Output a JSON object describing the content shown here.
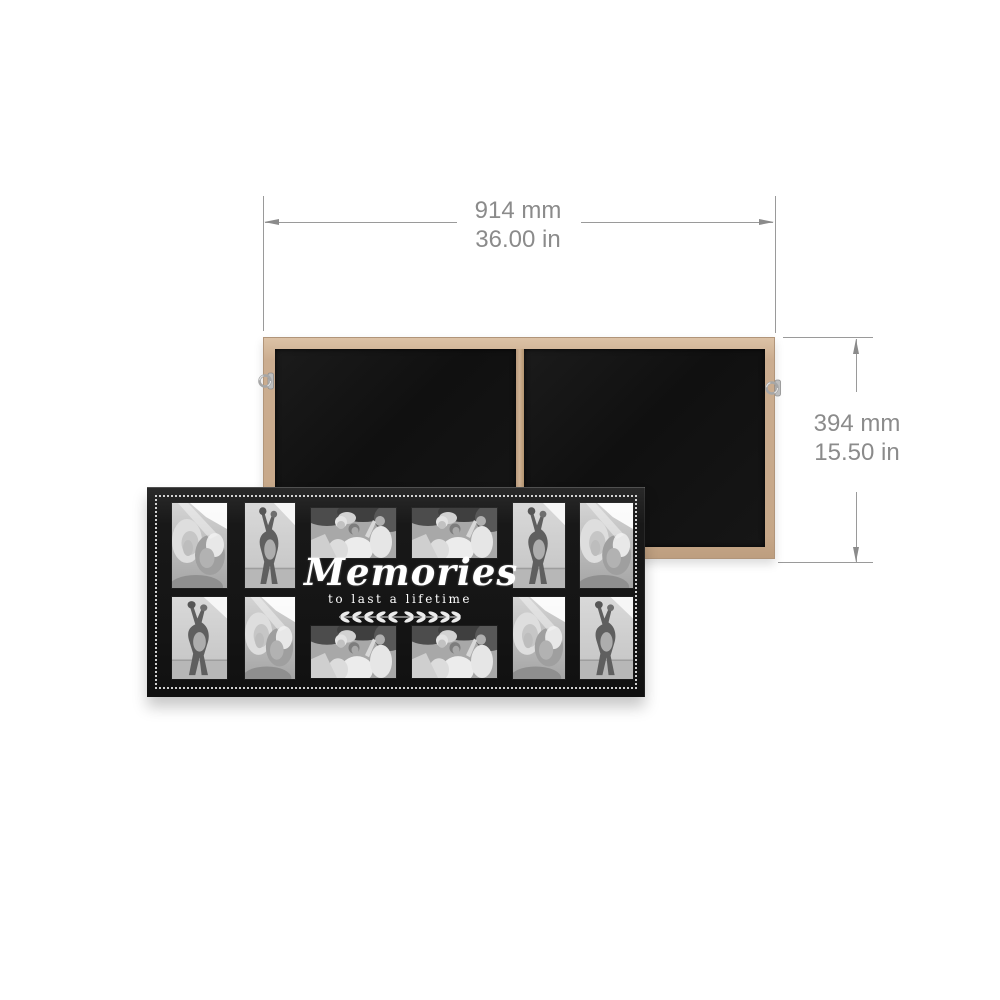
{
  "annotations": {
    "width": {
      "metric": "914 mm",
      "imperial": "36.00 in"
    },
    "height": {
      "metric": "394 mm",
      "imperial": "15.50 in"
    },
    "line_color": "#9a9a9a",
    "text_color": "#8b8b8b"
  },
  "back_frame": {
    "wood_color": "#c9ab8e",
    "backing_color": "#141414",
    "hardware": [
      "hanging-hook-left",
      "hanging-hook-right"
    ]
  },
  "front_frame": {
    "frame_color": "#1a1a1a",
    "beaded_border_color": "#f2f2f2",
    "caption": {
      "title": "Memories",
      "subtitle": "to last a lifetime",
      "ornament": "laurel-flourish-icon"
    },
    "photo_slots": [
      {
        "row": 1,
        "col": 1,
        "orientation": "portrait",
        "subject": "two women smiling"
      },
      {
        "row": 1,
        "col": 2,
        "orientation": "portrait",
        "subject": "dancing couple"
      },
      {
        "row": 1,
        "col": 3,
        "orientation": "landscape",
        "subject": "family outdoors"
      },
      {
        "row": 1,
        "col": 4,
        "orientation": "landscape",
        "subject": "family outdoors"
      },
      {
        "row": 1,
        "col": 5,
        "orientation": "portrait",
        "subject": "dancing couple"
      },
      {
        "row": 1,
        "col": 6,
        "orientation": "portrait",
        "subject": "two women smiling"
      },
      {
        "row": 2,
        "col": 1,
        "orientation": "portrait",
        "subject": "dancing couple"
      },
      {
        "row": 2,
        "col": 2,
        "orientation": "portrait",
        "subject": "two women smiling"
      },
      {
        "row": 2,
        "col": 3,
        "orientation": "landscape",
        "subject": "family outdoors"
      },
      {
        "row": 2,
        "col": 4,
        "orientation": "landscape",
        "subject": "family outdoors"
      },
      {
        "row": 2,
        "col": 5,
        "orientation": "portrait",
        "subject": "two women smiling"
      },
      {
        "row": 2,
        "col": 6,
        "orientation": "portrait",
        "subject": "dancing couple"
      }
    ]
  }
}
